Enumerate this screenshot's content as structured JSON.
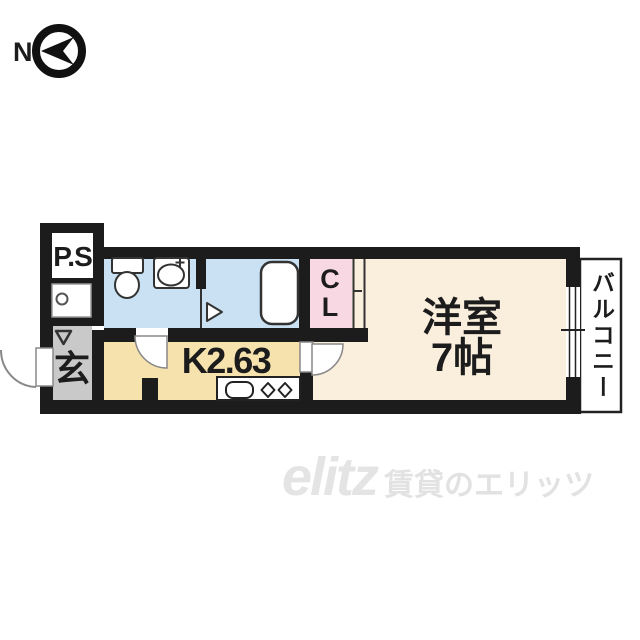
{
  "compass": {
    "label": "N",
    "icon": "circled-left-arrow"
  },
  "floorplan": {
    "labels": {
      "pipe_space": "P.S",
      "entrance": "玄",
      "kitchen": "K2.63",
      "closet_line1": "C",
      "closet_line2": "L",
      "living_line1": "洋室",
      "living_line2": "7帖",
      "balcony": "バルコニー"
    },
    "icons": {
      "entrance_marker": "down-chevron",
      "bath_door_marker": "right-triangle"
    },
    "colors": {
      "wall": "#1c1c1c",
      "wet_room": "#c9e1f2",
      "living": "#faeedd",
      "kitchen": "#f6e2ad",
      "closet": "#f8d8e3",
      "entrance": "#c9c9c9",
      "fixture": "#ffffff"
    }
  },
  "watermark": {
    "logo": "elitz",
    "text": "賃貸のエリッツ",
    "color": "#e3e3e3"
  }
}
